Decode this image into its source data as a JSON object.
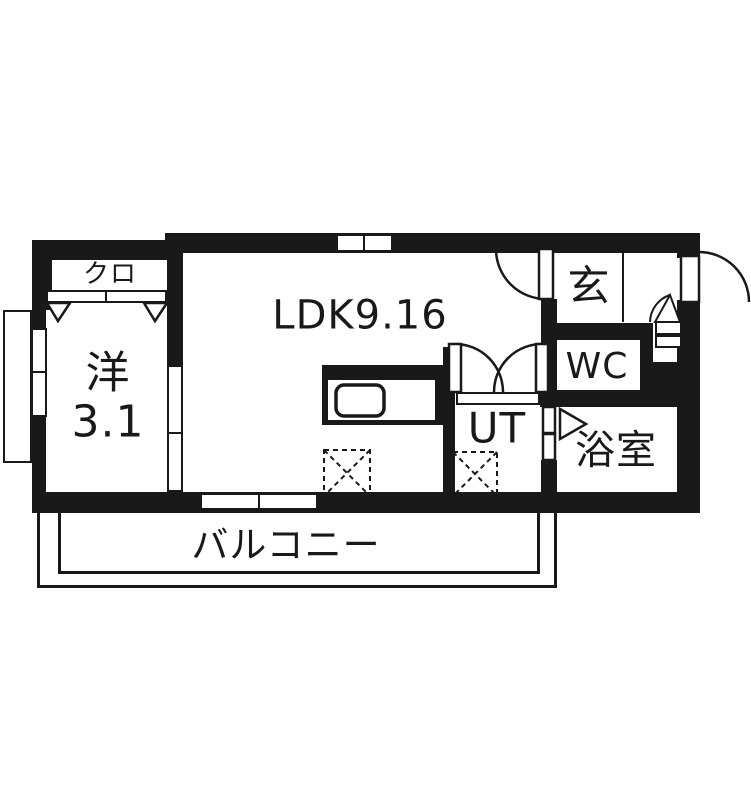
{
  "plan_title": "apartment-floor-plan",
  "colors": {
    "wall": "#191919",
    "background": "#ffffff"
  },
  "rooms": {
    "ldk": "LDK9.16",
    "western_room_name": "洋",
    "western_room_size": "3.1",
    "closet": "クロ",
    "entrance": "玄",
    "toilet": "WC",
    "utility": "UT",
    "bathroom": "浴室",
    "balcony": "バルコニー"
  }
}
